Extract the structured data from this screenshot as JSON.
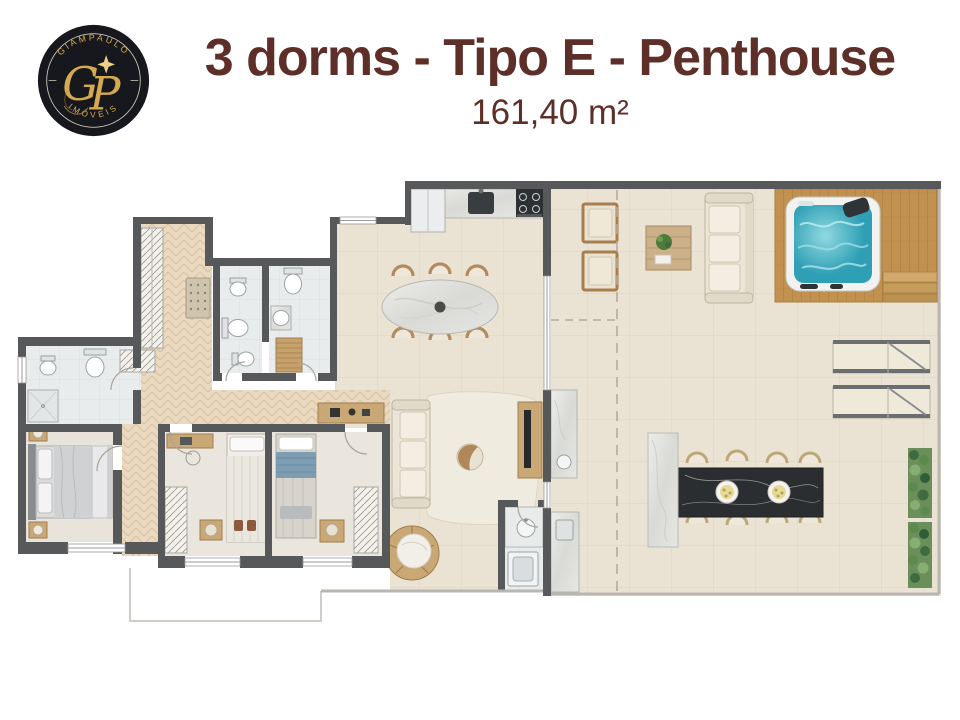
{
  "header": {
    "title": "3 dorms - Tipo E - Penthouse",
    "area": "161,40 m²"
  },
  "logo": {
    "top_text": "GIAMPAULO",
    "bottom_text": "IMÓVEIS",
    "monogram_g": "G",
    "monogram_p": "P",
    "sparkle_icon": "four-point-star"
  },
  "colors": {
    "title": "#5d2f28",
    "logo_bg": "#17181d",
    "logo_gold": "#d5a94e",
    "wall": "#57585a",
    "tile": "#eae3d4",
    "wood": "#ead9c0",
    "bath": "#e9ecec",
    "deck": "#c1914f",
    "water": "#39a8bc",
    "marble_dark": "#2b2e31",
    "marble_light": "#e9e8e4",
    "sofa": "#ece5d6",
    "wood_frame": "#b48b5e",
    "plant": "#4e7a3a"
  }
}
